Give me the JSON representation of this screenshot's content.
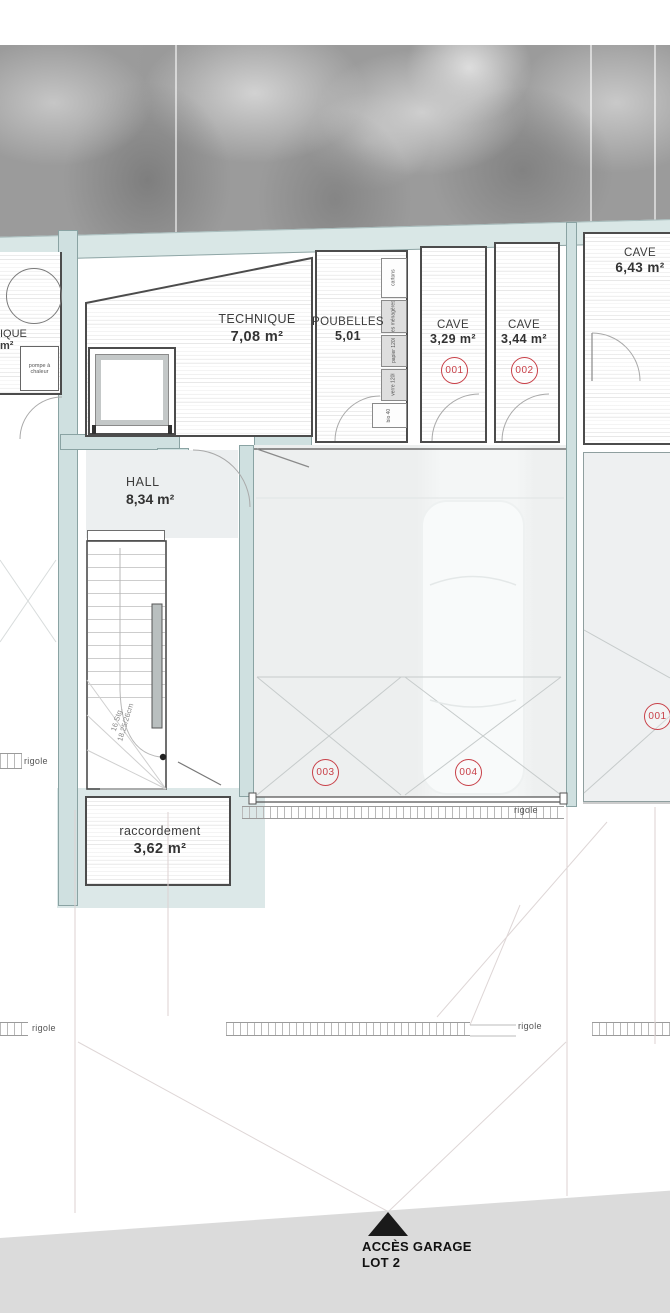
{
  "rooms": {
    "technique": {
      "name": "TECHNIQUE",
      "area": "7,08 m²"
    },
    "poubelles": {
      "name": "POUBELLES",
      "area": "5,01"
    },
    "cave_001": {
      "name": "CAVE",
      "area": "3,29 m²"
    },
    "cave_002": {
      "name": "CAVE",
      "area": "3,44 m²"
    },
    "cave_right": {
      "name": "CAVE",
      "area": "6,43 m²"
    },
    "hall": {
      "name": "HALL",
      "area": "8,34 m²"
    },
    "raccordement": {
      "name": "raccordement",
      "area": "3,62 m²"
    },
    "neighbor": {
      "name_fragment": "IQUE",
      "area_fragment": "m²",
      "equipment": "pompe à chaleur"
    }
  },
  "unit_tags": {
    "cave_001": "001",
    "cave_002": "002",
    "parking_003": "003",
    "parking_004": "004",
    "parking_right": "001"
  },
  "bins": [
    "cartons",
    "ordures ménagères 240l",
    "papier 120l",
    "verre 120l",
    "bio 40"
  ],
  "stair": {
    "note_line1": "16 Stg.",
    "note_line2": "18,25/26cm"
  },
  "drainage_label": "rigole",
  "access": {
    "line1": "ACCÈS GARAGE",
    "line2": "LOT 2"
  },
  "colors": {
    "wall_fill": "#cfe0e0",
    "band_fill": "#d9e7e6",
    "outline": "#4c4c4c",
    "accent_red": "#c84048",
    "marble_base": "#9b9b9b"
  }
}
